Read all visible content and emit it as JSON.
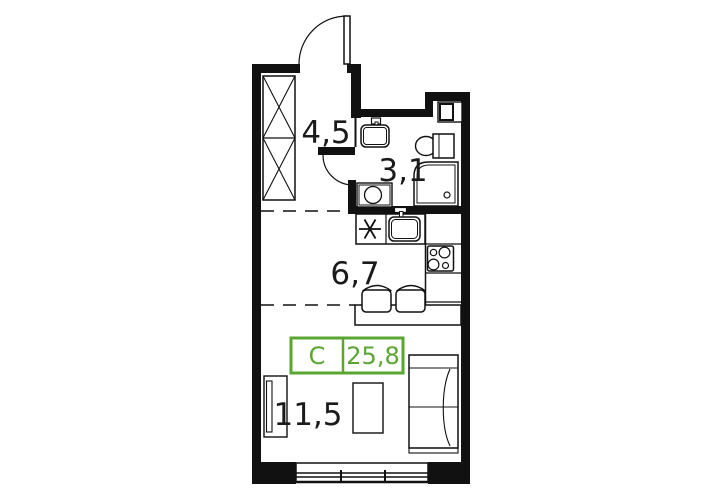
{
  "plan": {
    "unit_label": "С",
    "total_area": "25,8",
    "rooms": [
      {
        "id": "hallway",
        "area": "4,5"
      },
      {
        "id": "bathroom",
        "area": "3,1"
      },
      {
        "id": "kitchen",
        "area": "6,7"
      },
      {
        "id": "living-room",
        "area": "11,5"
      }
    ],
    "colors": {
      "accent_green": "#5AA630",
      "line": "#111111",
      "background": "#FFFFFF"
    }
  }
}
